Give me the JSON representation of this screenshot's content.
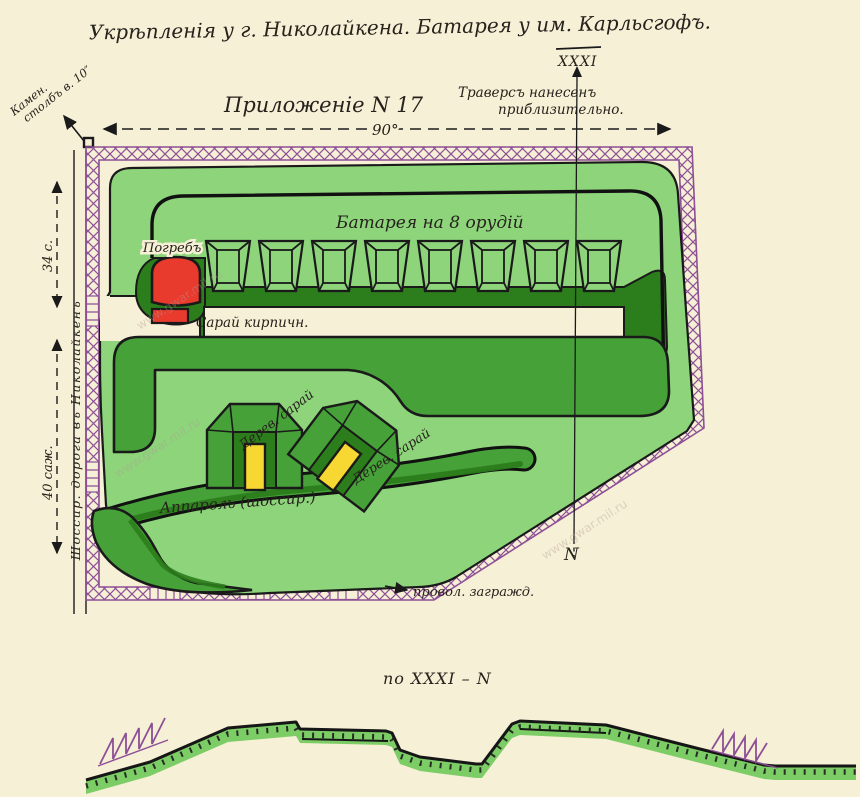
{
  "title": "Укрѣпленія у г. Николайкена. Батарея у им. Карльсгофъ.",
  "appendix_label": "Приложеніе N 17",
  "traverse_note": {
    "line1": "Траверсъ нанесенъ",
    "line2": "приблизительно."
  },
  "section": {
    "top_marker": "XXXI",
    "north_marker": "N",
    "profile_label": "по XXXI – N"
  },
  "dimensions": {
    "top_width": "90°",
    "left_upper": "34 с.",
    "left_lower": "40 саж."
  },
  "labels": {
    "battery": "Батарея на 8 орудій",
    "cellar": "Погребъ",
    "brick_shed": "Сарай кирпичн.",
    "wooden_shed_left": "Дерев. сарай",
    "wooden_shed_right": "Дерев. сарай",
    "ramp": "Аппарель (шоссир.)",
    "wire": "провол. загражд.",
    "road": "Шоссир. дорога въ Николайкенъ",
    "stone_pillar_line1": "Камен.",
    "stone_pillar_line2": "столбъ в. 10″"
  },
  "watermark": "www.gwar.mil.ru",
  "battery_guns": 8,
  "colors": {
    "paper": "#f6f0d6",
    "light_green": "#8dd47b",
    "medium_green": "#46a238",
    "dark_green": "#2c7d1c",
    "red": "#e83a2d",
    "yellow": "#f7d832",
    "purple": "#8d4f96",
    "ink": "#1a1a1a"
  }
}
